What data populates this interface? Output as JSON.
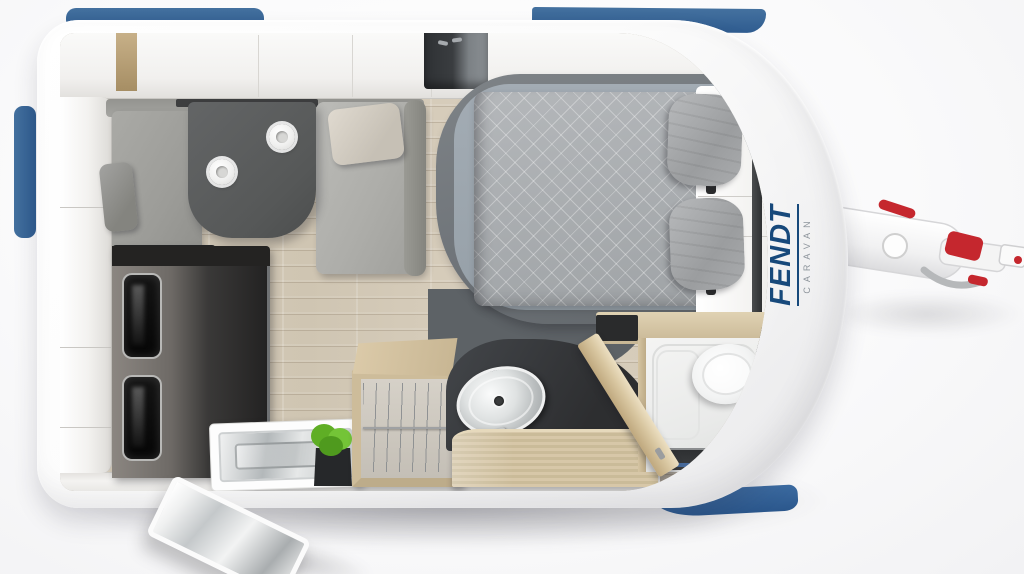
{
  "branding": {
    "name": "FENDT",
    "subtitle": "CARAVAN",
    "name_color": "#17497B",
    "subtitle_color": "#8E959C"
  },
  "palette": {
    "window_blue": "#38679C",
    "body_white": "#FBFBFB",
    "hitch_red": "#C5272E",
    "floor_wood": "#D7CDBC",
    "cabinet_wood": "#CDBC9A",
    "kitchen_dark": "#232222",
    "bench_gray": "#A2A29F",
    "table_gray": "#565858",
    "duvet_gray": "#A7ABAE",
    "bathroom_white": "#F2F2F1",
    "plant_green": "#5FAE25"
  }
}
